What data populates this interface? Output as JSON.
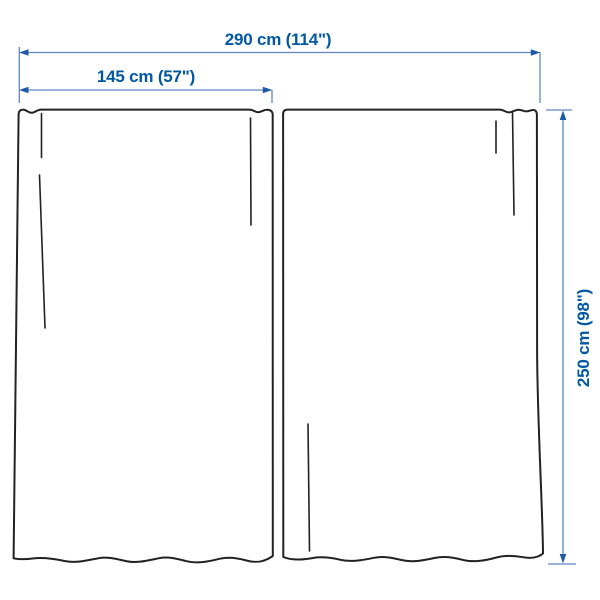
{
  "diagram": {
    "kind": "dimension-diagram",
    "dimensions": {
      "total_width": {
        "label": "290 cm (114\")"
      },
      "panel_width": {
        "label": "145 cm (57\")"
      },
      "height": {
        "label": "250 cm (98\")"
      }
    },
    "colors": {
      "label_text": "#0058a3",
      "dimension_line": "#6286c3",
      "arrowhead": "#1e5aa8",
      "outline": "#222222",
      "background": "#ffffff"
    }
  }
}
